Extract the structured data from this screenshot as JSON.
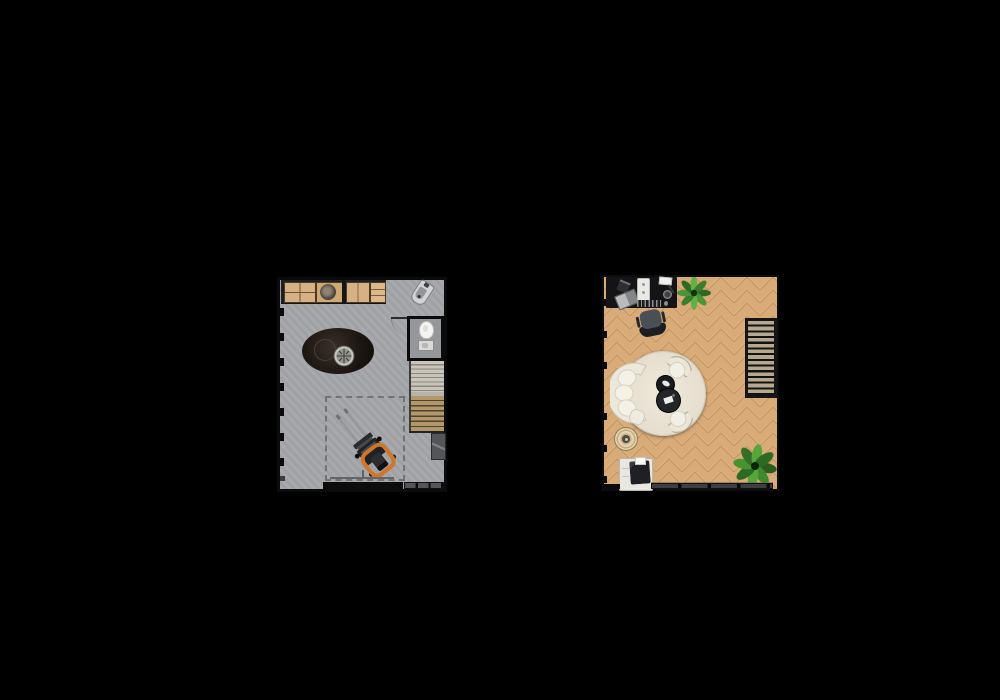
{
  "meta": {
    "scene": "Two top-down architectural floor-plan renders on a black background",
    "background": "#000000",
    "plan_count": 2
  },
  "palette": {
    "garage_floor": "#a5a6a9",
    "wall": "#0b0b0c",
    "bench_wood": "#d6b184",
    "forklift_orange": "#d0762a",
    "studio_floor": "#d8ab79",
    "herringbone_line": "#c4955f",
    "rug_cream": "#e7e0d1",
    "sofa_cream": "#ece8dc",
    "plant_green": "#4c9434",
    "stair_tread_dark": "#b5a88f",
    "stair_tread_wood": "#b2976a"
  },
  "plans": [
    {
      "id": "garage",
      "label": "Garage workshop floor plan (left)",
      "floor": "concrete",
      "items": [
        {
          "name": "workbench",
          "label": "Workbench with drawers, grinder and wood tops"
        },
        {
          "name": "utility-sink",
          "label": "Corner utility sink"
        },
        {
          "name": "inspection-pit",
          "label": "Dark oval inspection pit with drain grate"
        },
        {
          "name": "toilet-room",
          "label": "Small toilet room"
        },
        {
          "name": "toilet",
          "label": "Toilet"
        },
        {
          "name": "washbasin",
          "label": "Washbasin"
        },
        {
          "name": "staircase",
          "label": "Staircase to upper floor"
        },
        {
          "name": "marked-zone",
          "label": "Dashed marked floor zone"
        },
        {
          "name": "forklift",
          "label": "Orange forklift parked diagonally"
        },
        {
          "name": "floor-mat",
          "label": "Dark mat / leaning board"
        },
        {
          "name": "garage-door",
          "label": "Garage door opening"
        },
        {
          "name": "window-strip",
          "label": "Bottom window strip"
        },
        {
          "name": "windows-left",
          "label": "Left wall window ticks"
        }
      ]
    },
    {
      "id": "studio",
      "label": "Studio lounge floor plan (right)",
      "floor": "herringbone parquet",
      "items": [
        {
          "name": "desk",
          "label": "Black desk"
        },
        {
          "name": "laptop",
          "label": "Laptop"
        },
        {
          "name": "desktop-tower",
          "label": "White desktop unit"
        },
        {
          "name": "keyboard",
          "label": "Keyboard"
        },
        {
          "name": "desk-lamp",
          "label": "Desk lamp"
        },
        {
          "name": "office-chair",
          "label": "Office chair"
        },
        {
          "name": "plant-top",
          "label": "Potted plant (top)"
        },
        {
          "name": "round-rug",
          "label": "Large round cream rug"
        },
        {
          "name": "sofa",
          "label": "Curved cream sofa with cushions"
        },
        {
          "name": "armchair-top",
          "label": "Cream armchair (upper)"
        },
        {
          "name": "armchair-bottom",
          "label": "Cream armchair (lower)"
        },
        {
          "name": "coffee-table-small",
          "label": "Small round black coffee table"
        },
        {
          "name": "coffee-table-large",
          "label": "Large round black coffee table"
        },
        {
          "name": "small-round-rug",
          "label": "Small patterned round rug"
        },
        {
          "name": "printer-cabinet",
          "label": "White cabinet with printer"
        },
        {
          "name": "plant-bottom",
          "label": "Large potted plant (bottom right)"
        },
        {
          "name": "staircase",
          "label": "Open staircase"
        },
        {
          "name": "bottom-window",
          "label": "Bottom window wall"
        },
        {
          "name": "windows-left",
          "label": "Left wall window ticks"
        }
      ]
    }
  ]
}
